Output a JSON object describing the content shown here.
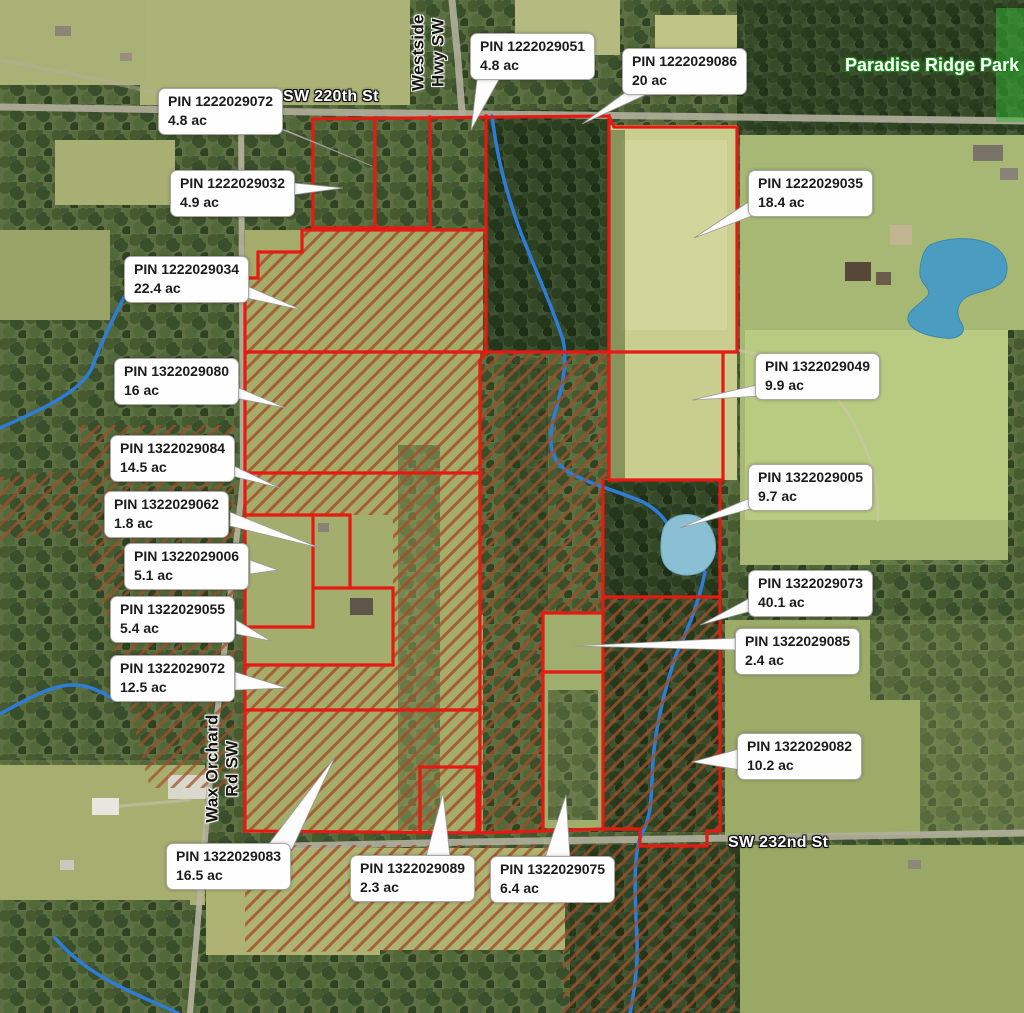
{
  "map": {
    "title": "Aerial parcel map with PIN and acreage callouts",
    "streets": {
      "sw_220th": "SW 220th St",
      "sw_232nd": "SW 232nd St",
      "westside_line1": "Westside",
      "westside_line2": "Hwy SW",
      "wax_line1": "Wax Orchard",
      "wax_line2": "Rd SW"
    },
    "park_label": "Paradise Ridge Park",
    "parcels": [
      {
        "pin": "PIN 1222029072",
        "area": "4.8 ac"
      },
      {
        "pin": "PIN 1222029032",
        "area": "4.9 ac"
      },
      {
        "pin": "PIN 1222029051",
        "area": "4.8 ac"
      },
      {
        "pin": "PIN 1222029086",
        "area": "20 ac"
      },
      {
        "pin": "PIN 1222029035",
        "area": "18.4 ac"
      },
      {
        "pin": "PIN 1322029049",
        "area": "9.9 ac"
      },
      {
        "pin": "PIN 1322029005",
        "area": "9.7 ac"
      },
      {
        "pin": "PIN 1322029073",
        "area": "40.1 ac"
      },
      {
        "pin": "PIN 1322029085",
        "area": "2.4 ac"
      },
      {
        "pin": "PIN 1322029082",
        "area": "10.2 ac"
      },
      {
        "pin": "PIN 1222029034",
        "area": "22.4 ac"
      },
      {
        "pin": "PIN 1322029080",
        "area": "16 ac"
      },
      {
        "pin": "PIN 1322029084",
        "area": "14.5 ac"
      },
      {
        "pin": "PIN 1322029062",
        "area": "1.8 ac"
      },
      {
        "pin": "PIN 1322029006",
        "area": "5.1 ac"
      },
      {
        "pin": "PIN 1322029055",
        "area": "5.4 ac"
      },
      {
        "pin": "PIN 1322029072",
        "area": "12.5 ac"
      },
      {
        "pin": "PIN 1322029083",
        "area": "16.5 ac"
      },
      {
        "pin": "PIN 1322029089",
        "area": "2.3 ac"
      },
      {
        "pin": "PIN 1322029075",
        "area": "6.4 ac"
      }
    ],
    "colors": {
      "parcel_outline": "#e61a12",
      "hatch": "#a34d28",
      "stream": "#2e7cd6",
      "pond": "#4a9cc0",
      "park_overlay": "#35b335",
      "label_background": "#fefefe",
      "label_text": "#1c1c1c"
    }
  }
}
